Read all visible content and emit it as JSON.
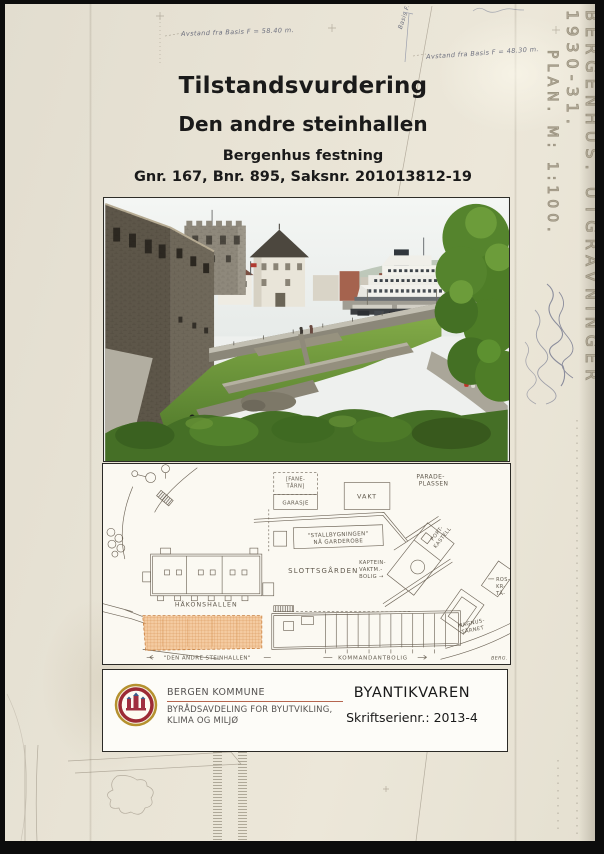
{
  "cover": {
    "title": "Tilstandsvurdering",
    "subtitle": "Den andre steinhallen",
    "site": "Bergenhus festning",
    "case_ref": "Gnr. 167, Bnr. 895, Saksnr. 201013812-19"
  },
  "scan_overlay": {
    "plan_title": "BERGENHUS. UTGRAVNINGER 1930-31.",
    "plan_scale": "PLAN. M: 1:100.",
    "note_left": "Avstand fra Basis F = 58.40 m.",
    "note_right": "Avstand fra Basis F = 48.30 m.",
    "note_basis": "Basis F."
  },
  "map": {
    "labels": {
      "parade_line1": "PARADE-",
      "parade_line2": "PLASSEN",
      "fanetarn_line1": "[FANE-",
      "fanetarn_line2": "TÅRN]",
      "garasje": "GARASJE",
      "vakt": "VAKT",
      "stall_line1": "\"STALLBYGNINGEN\"",
      "stall_line2": "NÅ GARDEROBE",
      "slottsgarden": "SLOTTSGÅRDEN",
      "kaptein_line1": "KAPTEIN-",
      "kaptein_line2": "VAKTM.-",
      "kaptein_line3": "BOLIG →",
      "port_line1": "PORT-",
      "port_line2": "KASTELL",
      "hakonshallen": "HÅKONSHALLEN",
      "den_andre": "\"DEN ANDRE STEINHALLEN\"",
      "kommandantbolig": "KOMMANDANTBOLIG",
      "magnus_line1": "MAGNUS-",
      "magnus_line2": "TÅRNET",
      "rosenkrantz_line1": "ROS-",
      "rosenkrantz_line2": "KR-",
      "rosenkrantz_line3": "TÅ-",
      "berg_initials": "BERG."
    }
  },
  "footer": {
    "org_line1": "BERGEN KOMMUNE",
    "org_line2": "BYRÅDSAVDELING FOR BYUTVIKLING,",
    "org_line3": "KLIMA OG MILJØ",
    "department": "BYANTIKVAREN",
    "series": "Skriftserienr.: 2013-4"
  },
  "colors": {
    "paper": "#e7e2d4",
    "highlight_orange": "#f0ab6a",
    "plan_ink": "#6e6558",
    "seal_red": "#9c2b35",
    "seal_gold": "#b5912f",
    "underline_red": "#b5654f"
  }
}
